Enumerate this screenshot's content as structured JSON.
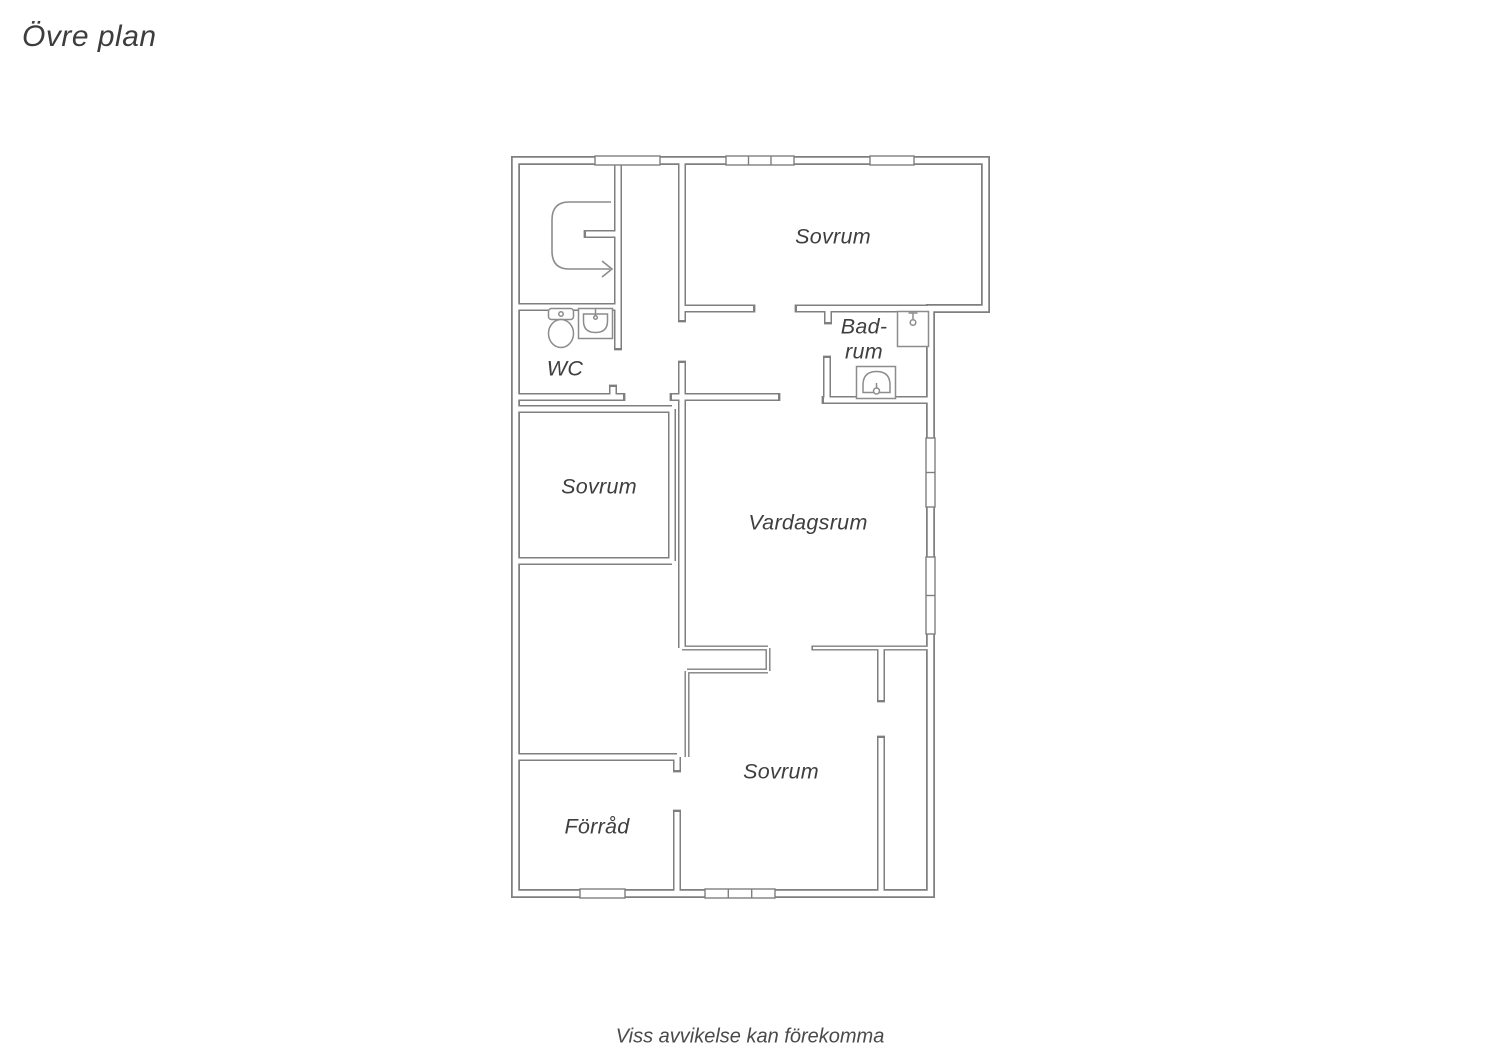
{
  "page": {
    "title": "Övre plan",
    "disclaimer": "Viss avvikelse kan förekomma"
  },
  "colors": {
    "wall": "#7f7f7f",
    "fixture": "#8c8c8c",
    "background": "#ffffff",
    "text": "#3f3f3f"
  },
  "floorplan": {
    "exterior_outline": "M 515.5 160.5 H 985.5 V 308.5 H 930.5 V 893.5 H 515.5 Z",
    "exterior_thickness": 9,
    "exterior_inner": 5.5,
    "wall_thickness": 8,
    "wall_inner": 5,
    "thin_thickness": 5,
    "thin_inner": 2.2,
    "walls": [
      {
        "seg": [
          618,
          160.5,
          618,
          348
        ],
        "cap": "e",
        "thin": false
      },
      {
        "seg": [
          618,
          234,
          586,
          234
        ],
        "cap": "e",
        "thin": false
      },
      {
        "seg": [
          515.5,
          307,
          618,
          307
        ],
        "cap": "",
        "thin": false
      },
      {
        "seg": [
          515.5,
          397,
          623,
          397
        ],
        "cap": "e",
        "thin": false
      },
      {
        "seg": [
          613,
          397,
          613,
          387
        ],
        "cap": "e",
        "thin": false
      },
      {
        "seg": [
          515.5,
          409,
          672,
          409
        ],
        "cap": "",
        "thin": false
      },
      {
        "seg": [
          672,
          409,
          672,
          561
        ],
        "cap": "",
        "thin": false
      },
      {
        "seg": [
          515.5,
          561,
          672,
          561
        ],
        "cap": "",
        "thin": false
      },
      {
        "seg": [
          682,
          363,
          682,
          648
        ],
        "cap": "s",
        "thin": false
      },
      {
        "seg": [
          672,
          397,
          778,
          397
        ],
        "cap": "se",
        "thin": false
      },
      {
        "seg": [
          682,
          160.5,
          682,
          320
        ],
        "cap": "e",
        "thin": false
      },
      {
        "seg": [
          682,
          308.5,
          753,
          308.5
        ],
        "cap": "e",
        "thin": false
      },
      {
        "seg": [
          797,
          308.5,
          930.5,
          308.5
        ],
        "cap": "s",
        "thin": false
      },
      {
        "seg": [
          828,
          308.5,
          828,
          322
        ],
        "cap": "e",
        "thin": false
      },
      {
        "seg": [
          827,
          358,
          827,
          400
        ],
        "cap": "s",
        "thin": false
      },
      {
        "seg": [
          824,
          400,
          930.5,
          400
        ],
        "cap": "s",
        "thin": false
      },
      {
        "seg": [
          881,
          648,
          881,
          700
        ],
        "cap": "e",
        "thin": false
      },
      {
        "seg": [
          881,
          738,
          881,
          893.5
        ],
        "cap": "s",
        "thin": false
      },
      {
        "seg": [
          515.5,
          757,
          677,
          757
        ],
        "cap": "",
        "thin": false
      },
      {
        "seg": [
          677,
          757,
          677,
          770
        ],
        "cap": "e",
        "thin": false
      },
      {
        "seg": [
          677,
          812,
          677,
          893.5
        ],
        "cap": "s",
        "thin": false
      },
      {
        "seg": [
          682,
          648,
          768,
          648
        ],
        "cap": "",
        "thin": true
      },
      {
        "seg": [
          768,
          648,
          768,
          671
        ],
        "cap": "",
        "thin": true
      },
      {
        "seg": [
          768,
          671,
          687,
          671
        ],
        "cap": "",
        "thin": true
      },
      {
        "seg": [
          687,
          671,
          687,
          757
        ],
        "cap": "",
        "thin": true
      },
      {
        "seg": [
          813,
          648,
          930.5,
          648
        ],
        "cap": "s",
        "thin": true
      }
    ],
    "windows": [
      {
        "x": 595,
        "y": 156,
        "w": 65,
        "h": 9,
        "dividers": []
      },
      {
        "x": 726,
        "y": 156,
        "w": 68,
        "h": 9,
        "dividers": [
          748.5,
          771
        ]
      },
      {
        "x": 870,
        "y": 156,
        "w": 44,
        "h": 9,
        "dividers": []
      },
      {
        "x": 926,
        "y": 438,
        "w": 9,
        "h": 69,
        "dividers": [
          472.5
        ]
      },
      {
        "x": 926,
        "y": 557,
        "w": 9,
        "h": 77,
        "dividers": [
          595.5
        ]
      },
      {
        "x": 580,
        "y": 889,
        "w": 45,
        "h": 9,
        "dividers": []
      },
      {
        "x": 705,
        "y": 889,
        "w": 70,
        "h": 9,
        "dividers": [
          728.3,
          751.7
        ]
      }
    ],
    "stairs": {
      "curve": "M 611 202 H 569 Q 552 202 552 220 V 251 Q 552 269 569 269 H 610",
      "arrowhead": "M 602 261 L 612 269 L 602 277"
    },
    "fixtures": [
      {
        "name": "toilet",
        "shapes": [
          {
            "type": "rect",
            "x": 548.5,
            "y": 308.5,
            "w": 25,
            "h": 11,
            "rx": 3
          },
          {
            "type": "circle",
            "cx": 561,
            "cy": 314,
            "r": 2.2
          },
          {
            "type": "ellipse",
            "cx": 561,
            "cy": 333.5,
            "rx": 12.5,
            "ry": 14
          }
        ]
      },
      {
        "name": "wc-sink",
        "shapes": [
          {
            "type": "rect",
            "x": 578.5,
            "y": 308.5,
            "w": 34,
            "h": 30,
            "rx": 0
          },
          {
            "type": "path",
            "d": "M 583.5 314 H 607.5 V 321 Q 607.5 332.5 595.5 332.5 Q 583.5 332.5 583.5 321 Z"
          },
          {
            "type": "line",
            "x1": 595.5,
            "y1": 308.5,
            "x2": 595.5,
            "y2": 315.5
          },
          {
            "type": "circle",
            "cx": 595.5,
            "cy": 317.5,
            "r": 1.8
          }
        ]
      },
      {
        "name": "shower",
        "shapes": [
          {
            "type": "rect",
            "x": 897.5,
            "y": 311.5,
            "w": 31,
            "h": 35,
            "rx": 0
          },
          {
            "type": "line",
            "x1": 908.5,
            "y1": 313,
            "x2": 917.5,
            "y2": 313
          },
          {
            "type": "line",
            "x1": 913,
            "y1": 313,
            "x2": 913,
            "y2": 319
          },
          {
            "type": "circle",
            "cx": 913,
            "cy": 322.5,
            "r": 2.8
          }
        ]
      },
      {
        "name": "bathroom-sink",
        "shapes": [
          {
            "type": "rect",
            "x": 856.5,
            "y": 366.5,
            "w": 39,
            "h": 32,
            "rx": 0
          },
          {
            "type": "path",
            "d": "M 863 392.5 V 385 Q 863 371.5 876.5 371.5 Q 890 371.5 890 385 V 392.5 Z"
          },
          {
            "type": "line",
            "x1": 876.5,
            "y1": 383,
            "x2": 876.5,
            "y2": 388
          },
          {
            "type": "circle",
            "cx": 876.5,
            "cy": 391,
            "r": 3
          }
        ]
      }
    ],
    "rooms": [
      {
        "id": "sovrum-top",
        "label": "Sovrum",
        "x": 833,
        "y": 237
      },
      {
        "id": "wc",
        "label": "WC",
        "x": 565,
        "y": 369
      },
      {
        "id": "badrum",
        "label": "Bad-\nrum",
        "x": 864,
        "y": 339
      },
      {
        "id": "sovrum-mid",
        "label": "Sovrum",
        "x": 599,
        "y": 487
      },
      {
        "id": "vardagsrum",
        "label": "Vardagsrum",
        "x": 808,
        "y": 523
      },
      {
        "id": "sovrum-bottom",
        "label": "Sovrum",
        "x": 781,
        "y": 772
      },
      {
        "id": "forrad",
        "label": "Förråd",
        "x": 597,
        "y": 827
      }
    ]
  }
}
